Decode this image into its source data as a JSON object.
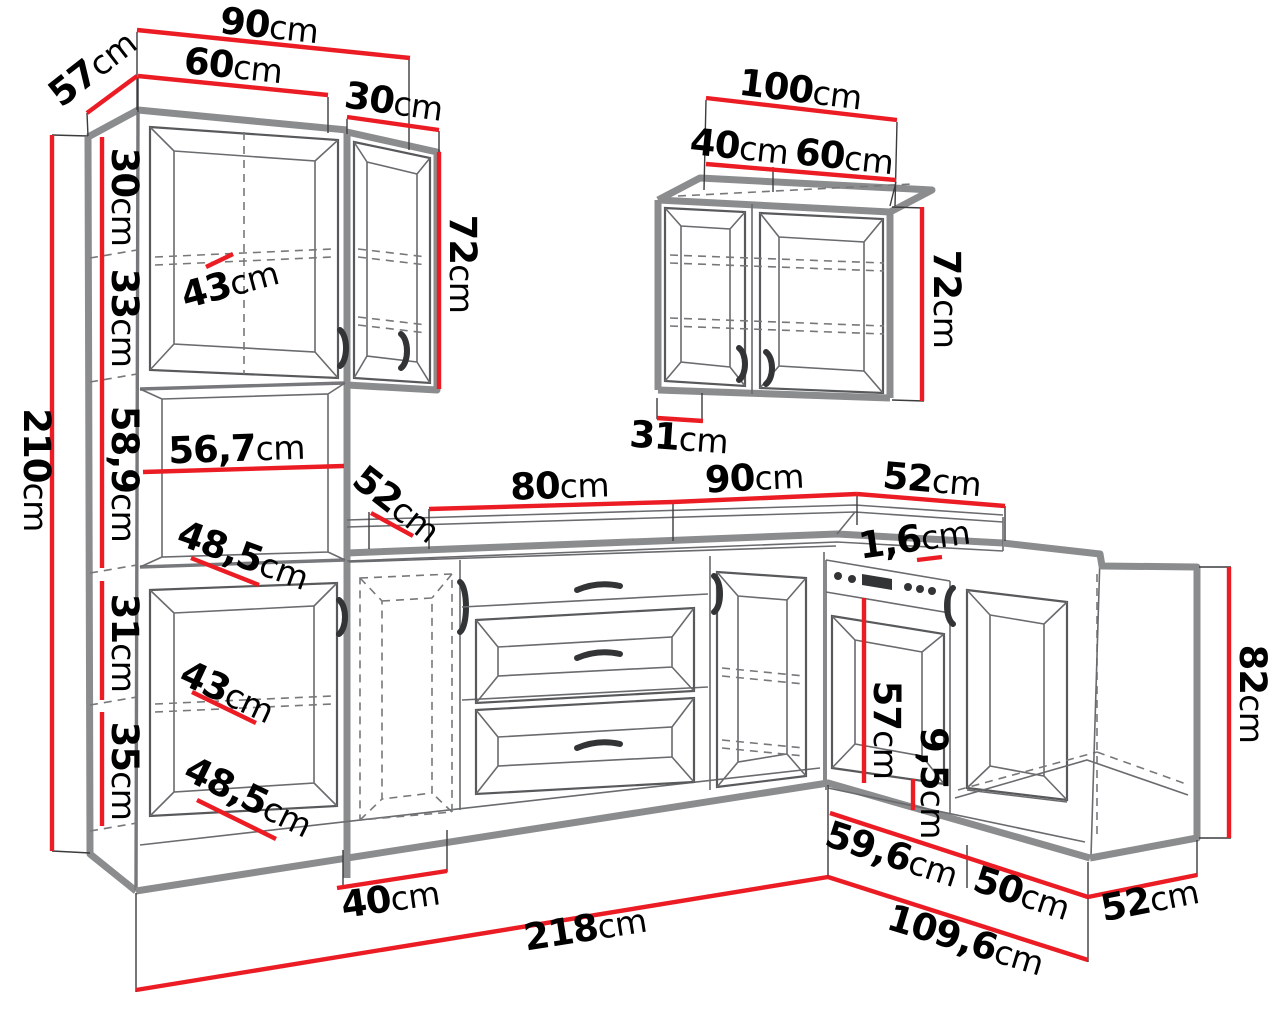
{
  "title": "Kitchen cabinet set dimension drawing",
  "units": "cm",
  "colors": {
    "dimension_line": "#ec1c24",
    "outline": "#8b8c8e",
    "text": "#000000",
    "background": "#ffffff"
  },
  "dims": {
    "top_total_width": {
      "value": "90",
      "unit": "cm"
    },
    "tall_width": {
      "value": "60",
      "unit": "cm"
    },
    "tall_depth": {
      "value": "57",
      "unit": "cm"
    },
    "wall30_width": {
      "value": "30",
      "unit": "cm"
    },
    "wall30_height": {
      "value": "72",
      "unit": "cm"
    },
    "tall_s1": {
      "value": "30",
      "unit": "cm"
    },
    "tall_s2": {
      "value": "33",
      "unit": "cm"
    },
    "tall_s3": {
      "value": "58,9",
      "unit": "cm"
    },
    "tall_s4": {
      "value": "31",
      "unit": "cm"
    },
    "tall_s5": {
      "value": "35",
      "unit": "cm"
    },
    "tall_height": {
      "value": "210",
      "unit": "cm"
    },
    "shelf43_top": {
      "value": "43",
      "unit": "cm"
    },
    "niche_width": {
      "value": "56,7",
      "unit": "cm"
    },
    "niche48_top": {
      "value": "48,5",
      "unit": "cm"
    },
    "counter_depth_left": {
      "value": "52",
      "unit": "cm"
    },
    "counter_80": {
      "value": "80",
      "unit": "cm"
    },
    "counter_90": {
      "value": "90",
      "unit": "cm"
    },
    "counter_52_right": {
      "value": "52",
      "unit": "cm"
    },
    "counter_thickness": {
      "value": "1,6",
      "unit": "cm"
    },
    "wall100_width": {
      "value": "100",
      "unit": "cm"
    },
    "wall100_door40": {
      "value": "40",
      "unit": "cm"
    },
    "wall100_door60": {
      "value": "60",
      "unit": "cm"
    },
    "wall100_height": {
      "value": "72",
      "unit": "cm"
    },
    "wall100_depth": {
      "value": "31",
      "unit": "cm"
    },
    "shelf43_bottom": {
      "value": "43",
      "unit": "cm"
    },
    "shelf48_bottom": {
      "value": "48,5",
      "unit": "cm"
    },
    "base40_width": {
      "value": "40",
      "unit": "cm"
    },
    "oven_height": {
      "value": "57",
      "unit": "cm"
    },
    "plinth_height": {
      "value": "9,5",
      "unit": "cm"
    },
    "corner_height": {
      "value": "82",
      "unit": "cm"
    },
    "run59_6": {
      "value": "59,6",
      "unit": "cm"
    },
    "run50": {
      "value": "50",
      "unit": "cm"
    },
    "corner_depth52": {
      "value": "52",
      "unit": "cm"
    },
    "total_left_run": {
      "value": "218",
      "unit": "cm"
    },
    "total_right_run": {
      "value": "109,6",
      "unit": "cm"
    }
  }
}
